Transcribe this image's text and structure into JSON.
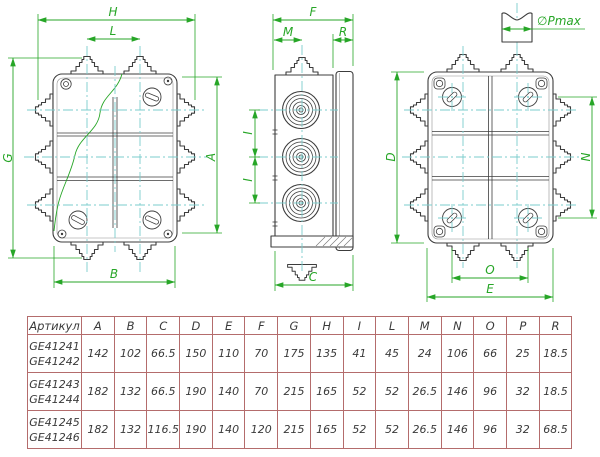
{
  "colors": {
    "dimension_green": "#27a627",
    "centerline_cyan": "#7bcccc",
    "outline_gray": "#3c3c3c",
    "table_border_red": "#b46c6c",
    "table_text": "#3a3a3a",
    "background": "#ffffff"
  },
  "drawing": {
    "labels": {
      "H": "H",
      "L": "L",
      "G": "G",
      "A": "A",
      "B": "B",
      "F": "F",
      "M": "M",
      "R": "R",
      "C": "C",
      "I": "I",
      "D": "D",
      "N": "N",
      "O": "O",
      "E": "E",
      "pmax": "∅Pmax"
    }
  },
  "table": {
    "headers": [
      "Артикул",
      "A",
      "B",
      "C",
      "D",
      "E",
      "F",
      "G",
      "H",
      "I",
      "L",
      "M",
      "N",
      "O",
      "P",
      "R"
    ],
    "rows": [
      {
        "articles": [
          "GE41241",
          "GE41242"
        ],
        "values": [
          "142",
          "102",
          "66.5",
          "150",
          "110",
          "70",
          "175",
          "135",
          "41",
          "45",
          "24",
          "106",
          "66",
          "25",
          "18.5"
        ]
      },
      {
        "articles": [
          "GE41243",
          "GE41244"
        ],
        "values": [
          "182",
          "132",
          "66.5",
          "190",
          "140",
          "70",
          "215",
          "165",
          "52",
          "52",
          "26.5",
          "146",
          "96",
          "32",
          "18.5"
        ]
      },
      {
        "articles": [
          "GE41245",
          "GE41246"
        ],
        "values": [
          "182",
          "132",
          "116.5",
          "190",
          "140",
          "120",
          "215",
          "165",
          "52",
          "52",
          "26.5",
          "146",
          "96",
          "32",
          "68.5"
        ]
      }
    ]
  }
}
